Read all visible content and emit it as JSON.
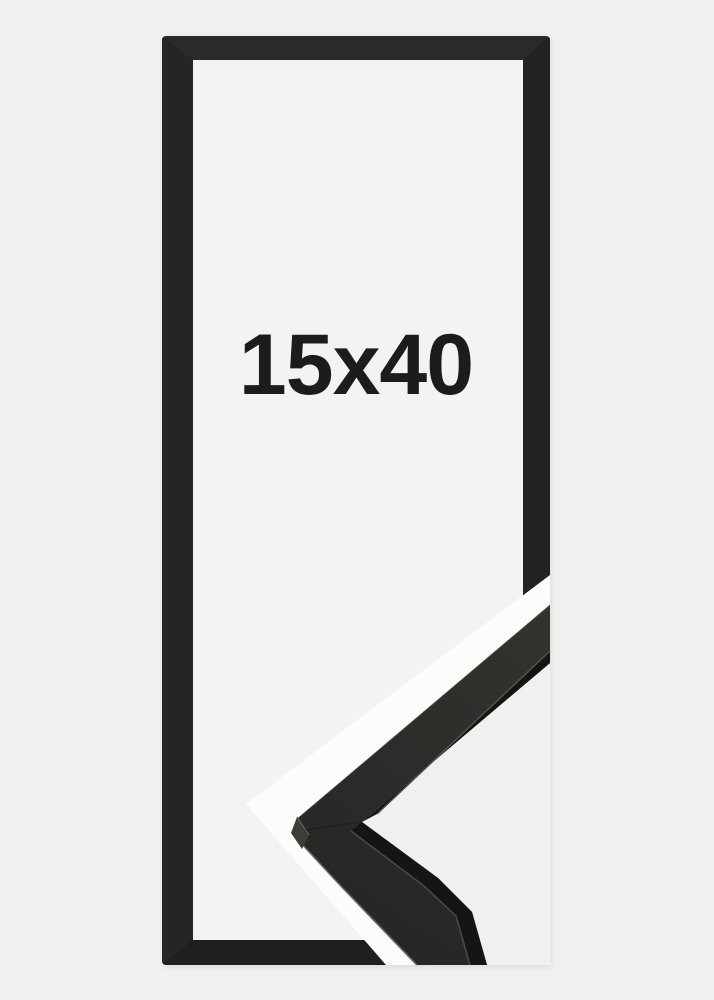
{
  "product": {
    "size_label": "15x40"
  },
  "colors": {
    "background": "#f1f0ee",
    "frame_interior": "#f4f3f1",
    "frame_black_top": "#2b2a28",
    "frame_black_side": "#232221",
    "divider_white": "#fcfcfb",
    "label_text": "#1c1c1a",
    "moulding_face_light": "#34332f",
    "moulding_face_dark": "#252422",
    "moulding_lip_dark": "#141413",
    "moulding_edge_highlight": "#55534e",
    "moulding_miter_face": "#3d3c39"
  }
}
